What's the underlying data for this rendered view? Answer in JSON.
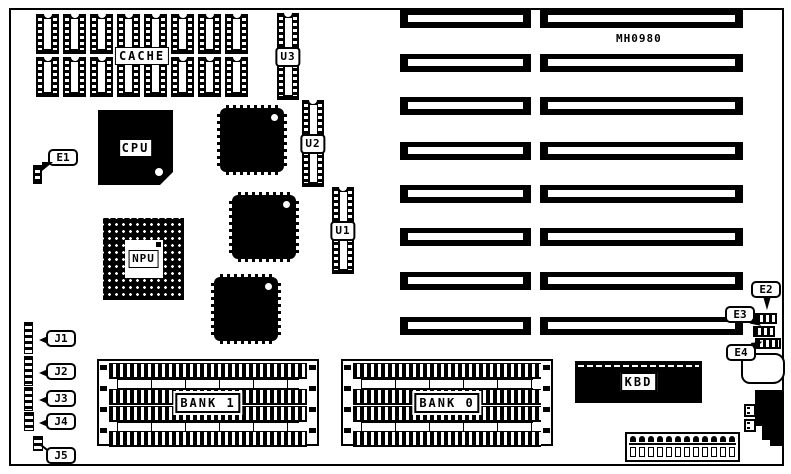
{
  "board": {
    "part_number": "MH0980",
    "cache": {
      "label": "CACHE",
      "chip_columns": 8,
      "chip_rows": 2
    },
    "cpu": {
      "label": "CPU"
    },
    "npu": {
      "label": "NPU"
    },
    "kbd": {
      "label": "KBD"
    },
    "banks": [
      {
        "label": "BANK 1"
      },
      {
        "label": "BANK 0"
      }
    ],
    "rom_chips": [
      {
        "label": "U3"
      },
      {
        "label": "U2"
      },
      {
        "label": "U1"
      }
    ],
    "jumpers": [
      {
        "label": "E1"
      },
      {
        "label": "E2"
      },
      {
        "label": "E3"
      },
      {
        "label": "E4"
      }
    ],
    "headers": [
      {
        "label": "J1"
      },
      {
        "label": "J2"
      },
      {
        "label": "J3"
      },
      {
        "label": "J4"
      },
      {
        "label": "J5"
      }
    ],
    "expansion_slots": {
      "rows": 8,
      "columns": 2
    },
    "colors": {
      "ink": "#000000",
      "background": "#ffffff"
    }
  }
}
